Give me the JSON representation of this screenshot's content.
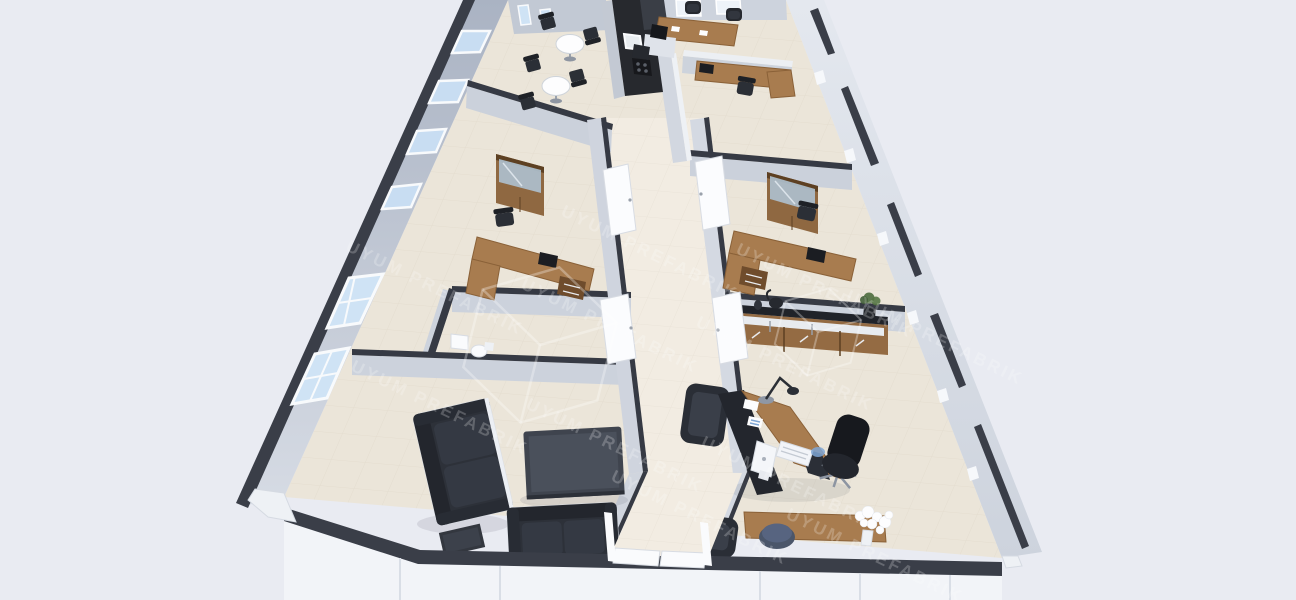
{
  "scene": {
    "type": "3d-render",
    "view": "isometric dollhouse cutaway of a prefabricated modular office interior",
    "watermark": {
      "text": "UYUM PREFABRIK",
      "logo": "isometric-cube-wireframe",
      "angle_deg": 26,
      "opacity": 0.22
    },
    "palette": {
      "background": "#e9ebf2",
      "exterior_wall": "#b6bece",
      "interior_wall": "#ced4de",
      "wall_cap": "#3a3e48",
      "front_panel": "#f2f4f8",
      "floor_tile": "#ebe5d9",
      "corridor_tile": "#f2ece2",
      "wood": "#a87c4f",
      "wood_dark": "#6f4c2c",
      "furniture_dark": "#2d3139",
      "window_glass": "#c8ddf2",
      "plant_green": "#4d6b3d",
      "accent_blue": "#7fa6d4"
    },
    "building": {
      "windows_left_wall": 6,
      "exterior_finish": "light gray panels with dark trim caps"
    },
    "rooms": [
      {
        "name": "break-room",
        "furniture": [
          "kitchenette counter with sink and cooktop",
          "tall dark cabinet",
          "round bistro table",
          "round bistro table",
          "black stacking chairs"
        ]
      },
      {
        "name": "meeting-room",
        "furniture": [
          "rectangular wooden meeting table",
          "black chairs",
          "papers"
        ]
      },
      {
        "name": "open-plan-cubicle",
        "furniture": [
          "low partition panels",
          "L-shaped wooden desk",
          "black task chair",
          "monitor"
        ]
      },
      {
        "name": "office-left",
        "furniture": [
          "L-shaped wooden desk",
          "black task chair",
          "wooden display cabinet with glass doors",
          "drawer pedestal",
          "monitor"
        ]
      },
      {
        "name": "office-right",
        "furniture": [
          "L-shaped wooden desk",
          "black task chair",
          "wooden display cabinet with glass doors",
          "drawer pedestal",
          "monitor"
        ]
      },
      {
        "name": "wc",
        "furniture": [
          "washbasin",
          "toilet"
        ]
      },
      {
        "name": "lounge",
        "furniture": [
          "three-seat black sofa",
          "two-seat black sofa",
          "dark coffee table",
          "dark side table"
        ]
      },
      {
        "name": "executive-office",
        "furniture": [
          "executive desk with wooden top",
          "wooden return unit",
          "black executive chair",
          "guest armchair",
          "guest armchair",
          "desktop computer",
          "white keyboard",
          "mouse pad",
          "desk lamp",
          "documents",
          "blue stool",
          "vase with white flowers",
          "sideboard with kettle and potted plant"
        ]
      },
      {
        "name": "corridor",
        "furniture": [
          "open white doors",
          "ceramic tile flooring",
          "entrance doors"
        ]
      }
    ]
  }
}
